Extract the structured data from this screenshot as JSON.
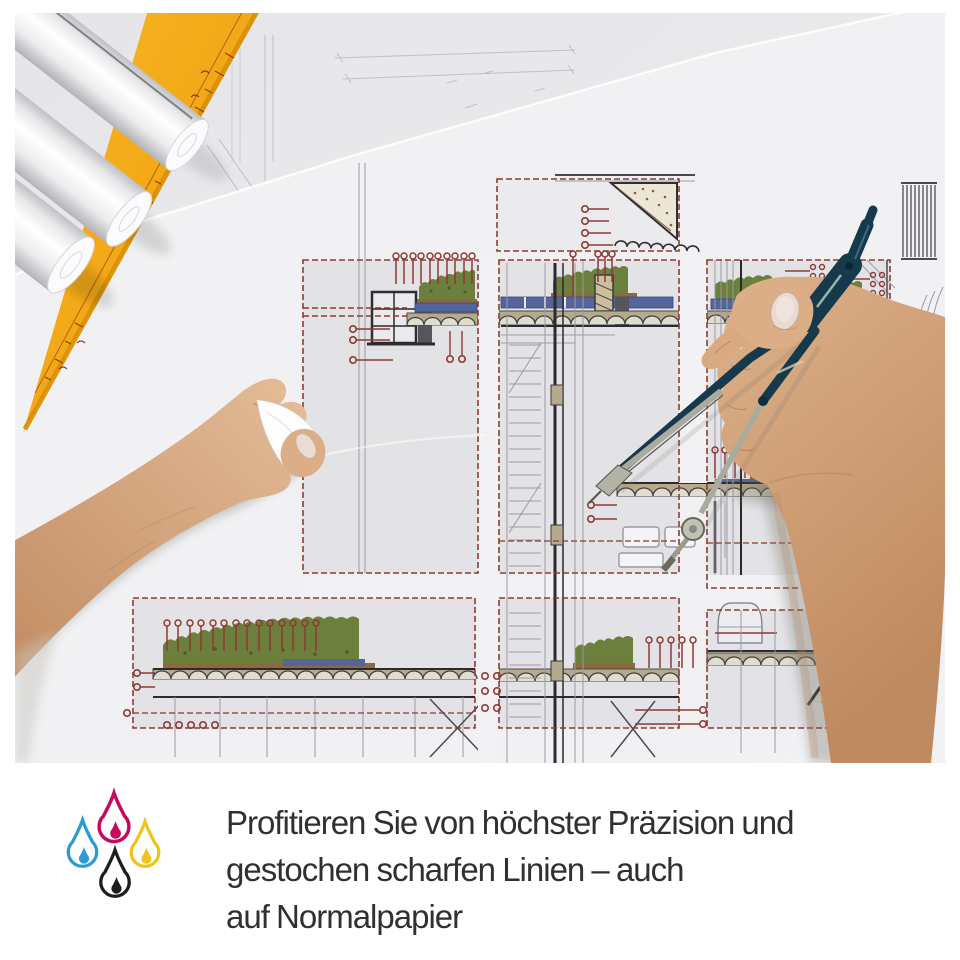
{
  "caption": {
    "lines": [
      "Profitieren Sie von höchster Präzision und",
      "gestochen scharfen Linien – auch",
      "auf Normalpapier"
    ],
    "text_color": "#303030"
  },
  "ink_drops_icon": {
    "label": "cmyk-ink-drops",
    "drops": [
      {
        "name": "cyan-drop",
        "color": "#2f9ad2"
      },
      {
        "name": "magenta-drop",
        "color": "#c6085f"
      },
      {
        "name": "yellow-drop",
        "color": "#eec31a"
      },
      {
        "name": "black-drop",
        "color": "#1d1d1d"
      }
    ]
  },
  "photo": {
    "palette": {
      "paper": "#f2f2f4",
      "under_paper": "#e7e7ea",
      "blueprint_red": "#8e3a33",
      "structure_gray": "#9a9aa1",
      "vegetation_green": "#6d7f3c",
      "soil_brown": "#8b6a40",
      "insulation_blue": "#54659b",
      "slab_tan": "#b6aa8d",
      "set_square_orange": "#f2a30a",
      "compass_teal": "#16394b",
      "skin_tone": "#d7a786"
    }
  }
}
